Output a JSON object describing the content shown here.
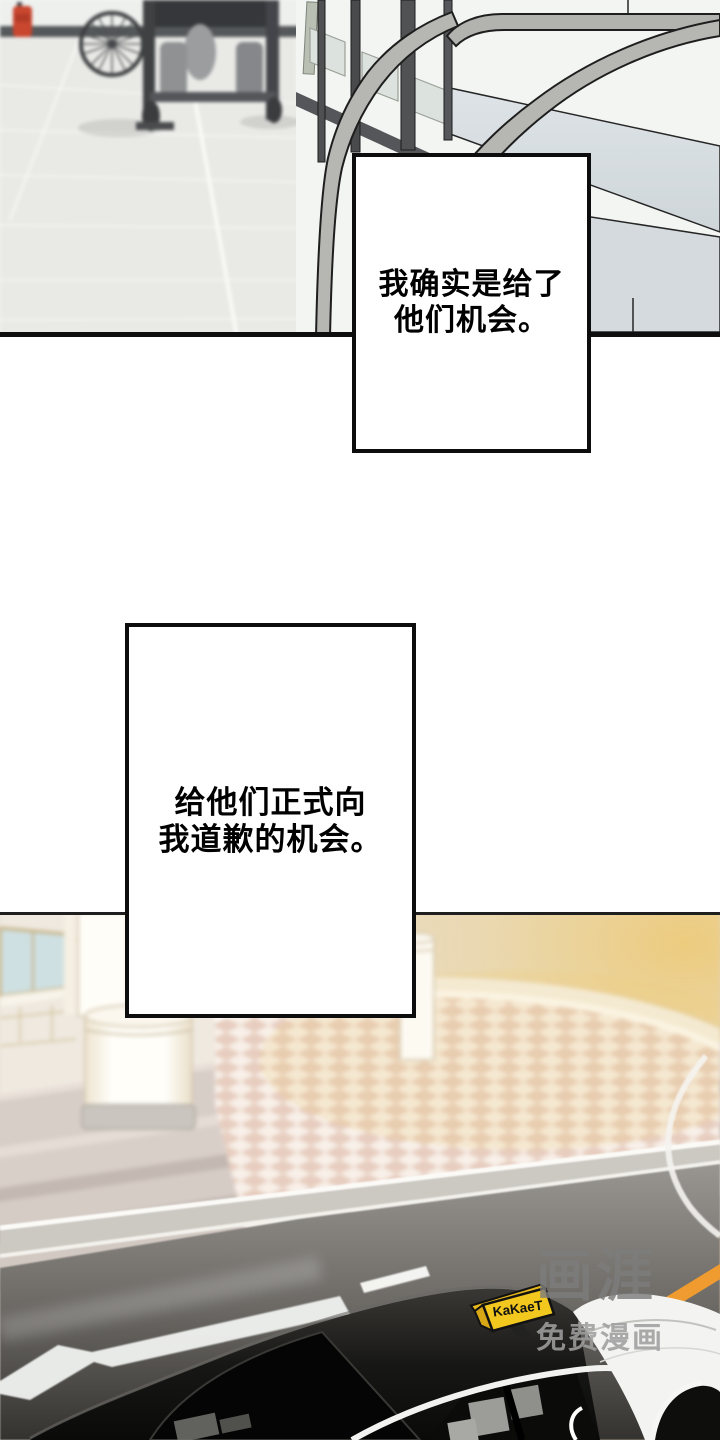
{
  "panel1": {
    "caption": {
      "line1": "我确实是给了",
      "line2": "他们机会。"
    }
  },
  "panel2": {
    "caption": {
      "line1": "给他们正式向",
      "line2": "我道歉的机会。"
    },
    "taxi_sign_label": "KaKaeT",
    "watermark": {
      "logo": "画涯",
      "tagline": "免费漫画"
    }
  },
  "colors": {
    "panel_border": "#0d0d0d",
    "caption_text": "#000000",
    "taxi_sign_yellow": "#f2c71e",
    "stripe_orange": "#ef9b30",
    "glow_gold": "#eccb7d",
    "checker_pink": "#e7cdbf",
    "road_dark": "#3f3d3b",
    "railing_gray": "#b6b6b2",
    "extinguisher_red": "#c9462f",
    "watermark_gray": "#7d7d7d"
  }
}
